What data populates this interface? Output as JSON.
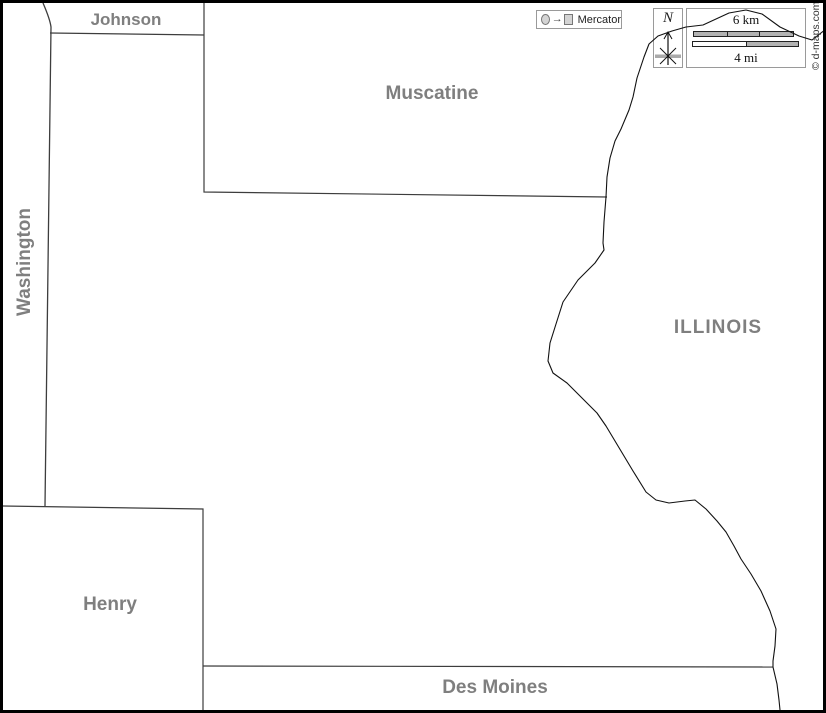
{
  "regions": {
    "johnson": "Johnson",
    "muscatine": "Muscatine",
    "washington": "Washington",
    "illinois": "ILLINOIS",
    "henry": "Henry",
    "des_moines": "Des Moines"
  },
  "legend": {
    "projection": "Mercator"
  },
  "compass": {
    "north": "N"
  },
  "scale": {
    "km": "6 km",
    "mi": "4 mi"
  },
  "credit": "© d-maps.com",
  "colors": {
    "label_gray": "#7f7f7f",
    "boundary": "#3d3d3d",
    "river": "#111111",
    "frame": "#000000",
    "box_border": "#9a9a9a",
    "bar_fill": "#b3b3b3"
  }
}
